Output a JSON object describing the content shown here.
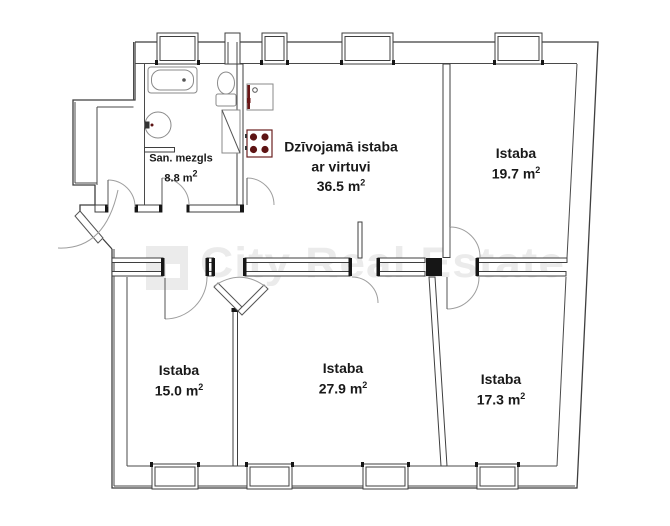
{
  "watermark": {
    "text": "City Real Estate",
    "color": "#ebebeb",
    "logo_color": "#ebebeb"
  },
  "colors": {
    "walls": "#3f3f3f",
    "jambs": "#161616",
    "stove_red": "#5d1313",
    "kitchen_red": "#6b1616"
  },
  "rooms": [
    {
      "id": "san-mezgls",
      "name": "San. mezgls",
      "area": "8.8 m",
      "sup": "2"
    },
    {
      "id": "living",
      "name": "Dzīvojamā istaba",
      "name2": "ar virtuvi",
      "area": "36.5 m",
      "sup": "2"
    },
    {
      "id": "istaba-19-7",
      "name": "Istaba",
      "area": "19.7 m",
      "sup": "2"
    },
    {
      "id": "istaba-15-0",
      "name": "Istaba",
      "area": "15.0 m",
      "sup": "2"
    },
    {
      "id": "istaba-27-9",
      "name": "Istaba",
      "area": "27.9 m",
      "sup": "2"
    },
    {
      "id": "istaba-17-3",
      "name": "Istaba",
      "area": "17.3 m",
      "sup": "2"
    }
  ]
}
